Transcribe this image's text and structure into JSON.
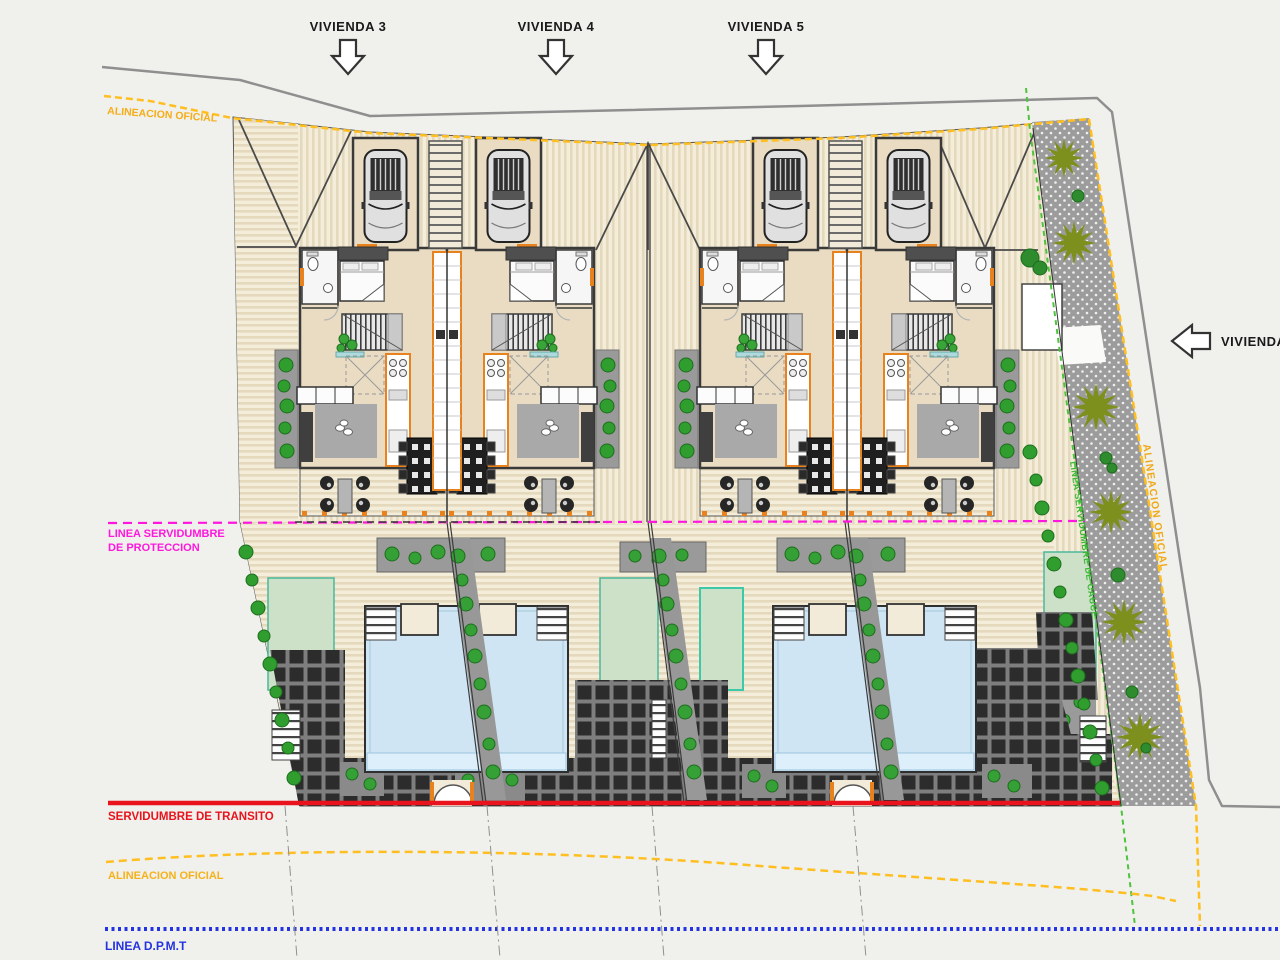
{
  "drawing_title": "Site plan - viviendas pareadas",
  "title_arrows": {
    "v3": "VIVIENDA 3",
    "v4": "VIVIENDA 4",
    "v5": "VIVIENDA 5",
    "right": "VIVIENDA"
  },
  "boundaries": {
    "alineacion_top": "ALINEACION OFICIAL",
    "proteccion_line1": "LINEA SERVIDUMBRE",
    "proteccion_line2": "DE PROTECCION",
    "transito": "SERVIDUMBRE DE TRANSITO",
    "alineacion_bottom": "ALINEACION OFICIAL",
    "dpmt": "LINEA D.P.M.T",
    "alineacion_right": "ALINEACION OFICIAL",
    "cauce": "LINEA SERVIDUMBRE DE CAUCE"
  },
  "colors": {
    "official_yellow": "#f5ad18",
    "protection_magenta": "#ff17dd",
    "transit_red": "#e8131c",
    "dpmt_blue": "#2433e0",
    "cauce_green": "#3cb838",
    "road_gray": "#8f8f8f",
    "label_dark": "#1a1a1a",
    "accent_orange": "#e8821e"
  }
}
